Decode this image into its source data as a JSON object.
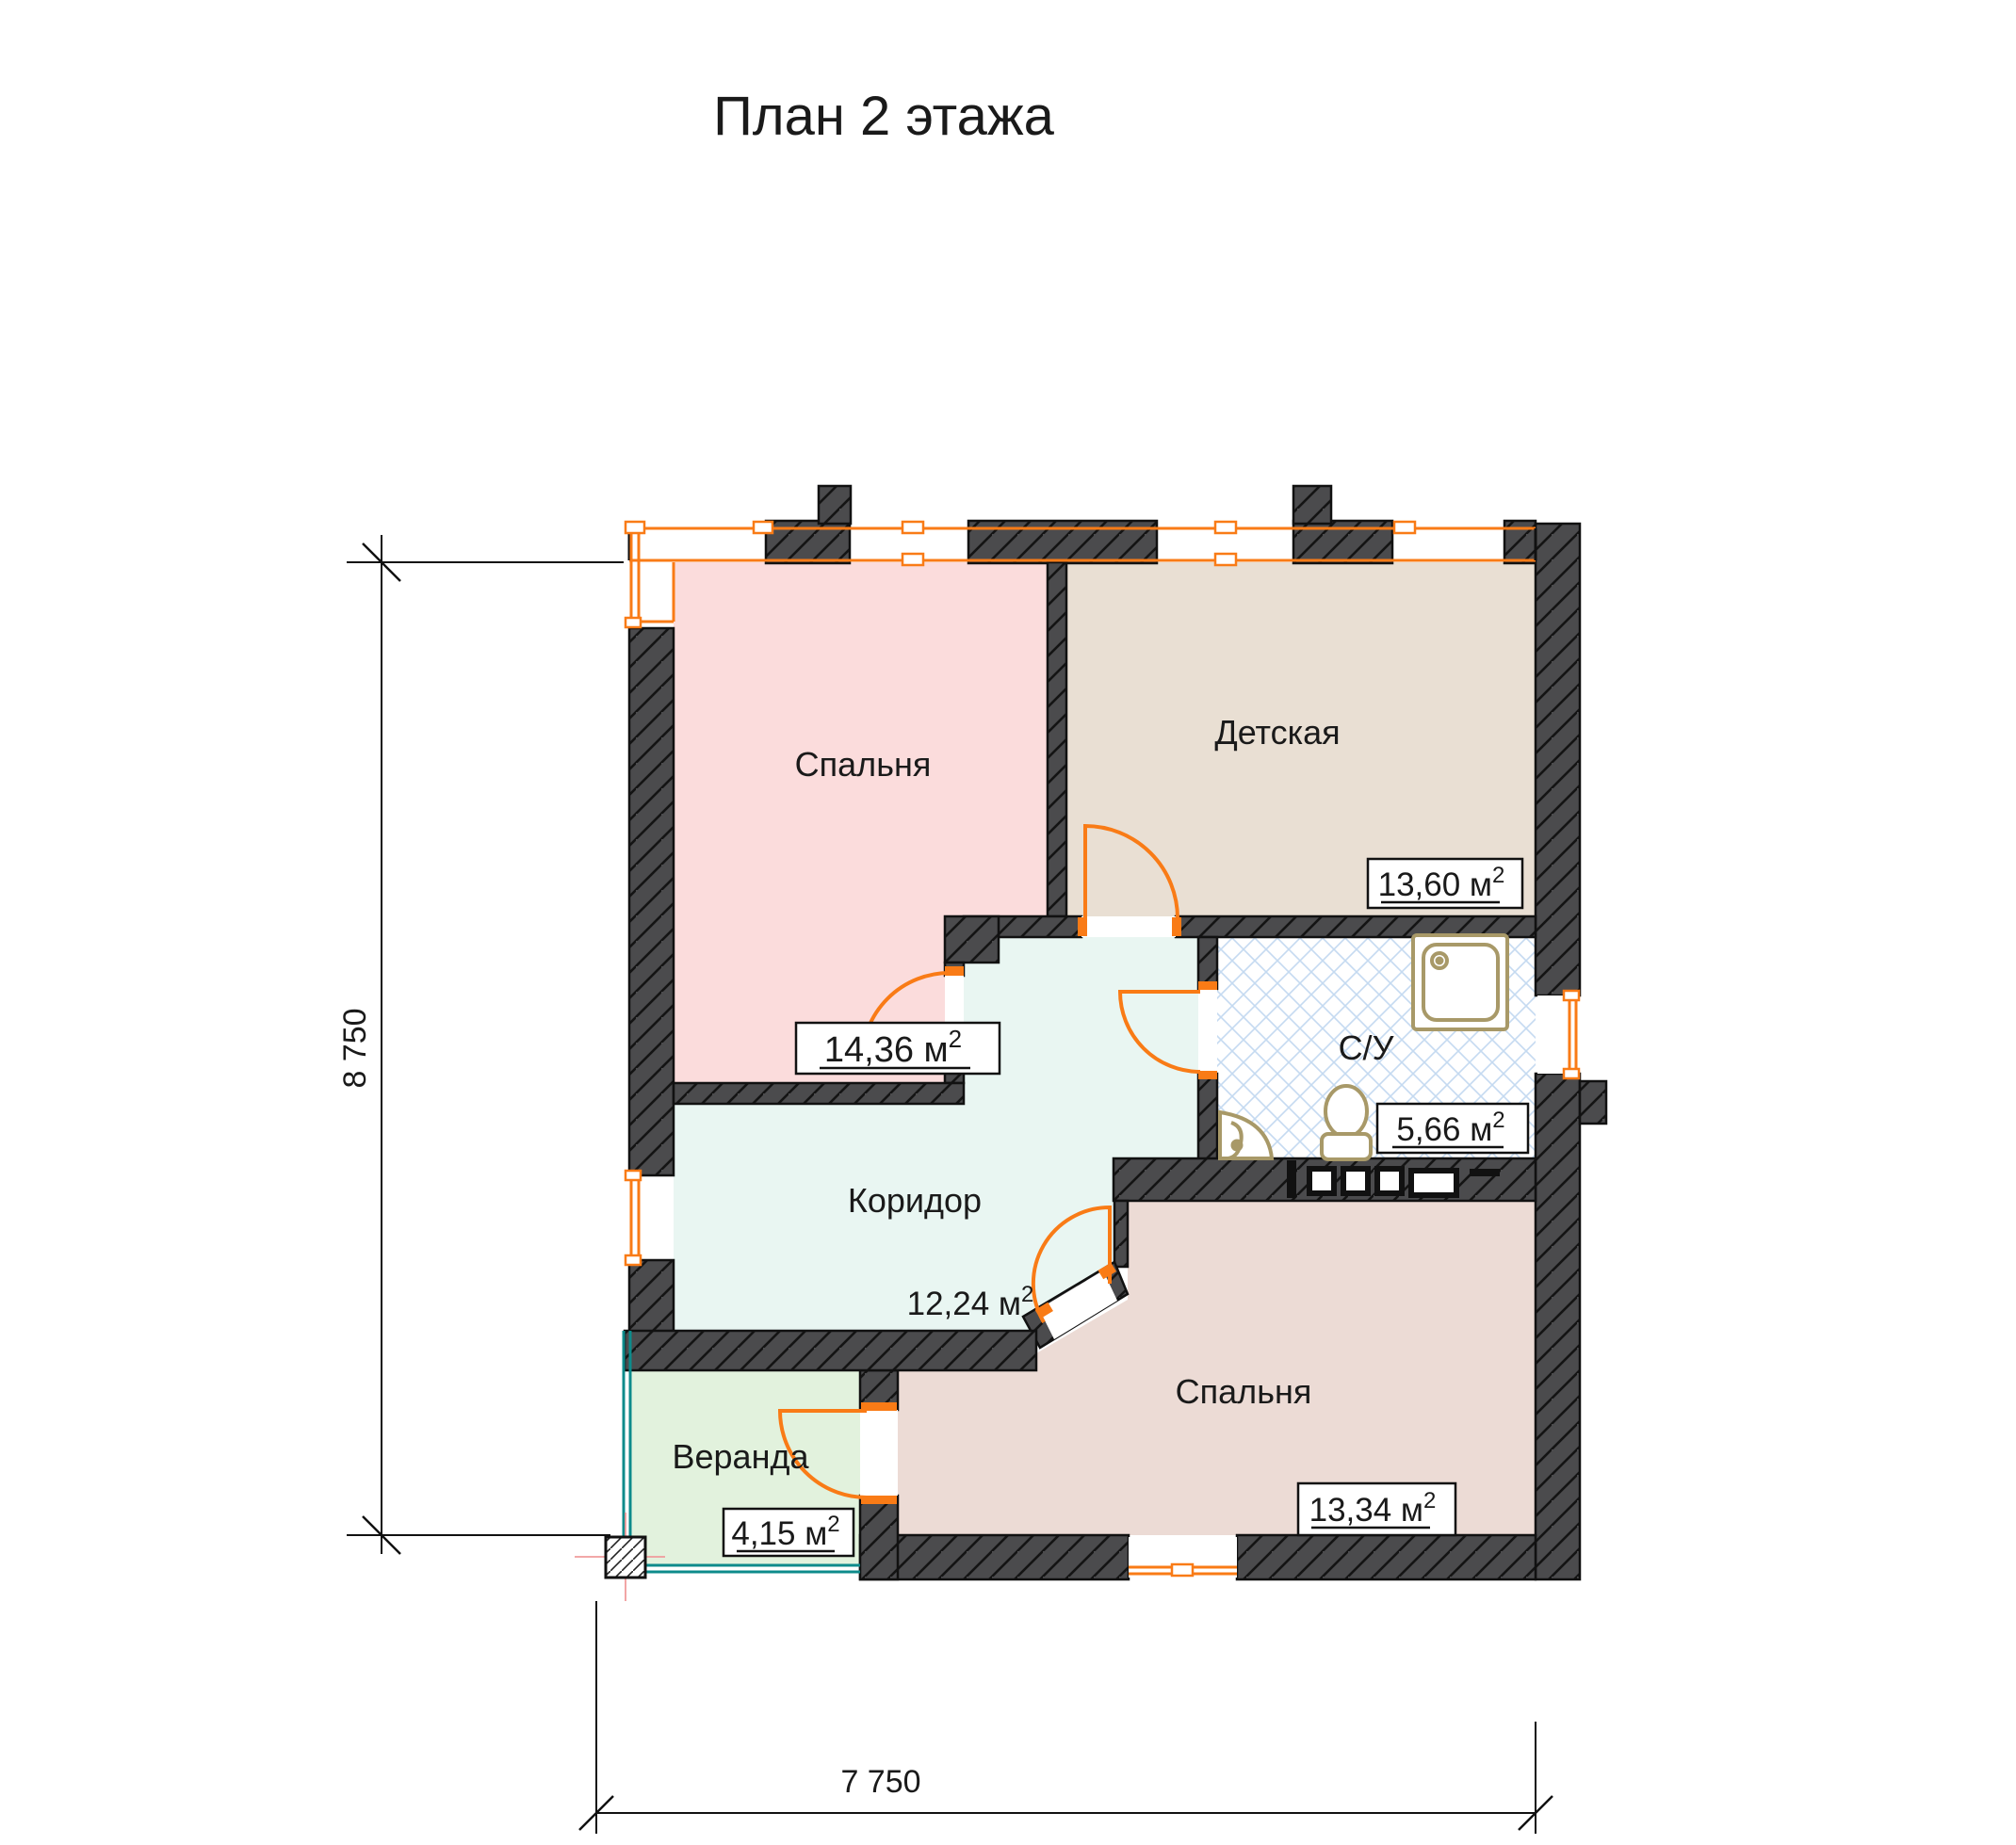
{
  "title": "План 2 этажа",
  "plan": {
    "rooms": [
      {
        "id": "bedroom-top",
        "name": "Спальня",
        "area_value": "14,36 м",
        "area_sup": "2"
      },
      {
        "id": "nursery",
        "name": "Детская",
        "area_value": "13,60 м",
        "area_sup": "2"
      },
      {
        "id": "bathroom",
        "name": "С/У",
        "area_value": "5,66 м",
        "area_sup": "2"
      },
      {
        "id": "corridor",
        "name": "Коридор",
        "area_value": "12,24 м",
        "area_sup": "2"
      },
      {
        "id": "bedroom-bottom",
        "name": "Спальня",
        "area_value": "13,34 м",
        "area_sup": "2"
      },
      {
        "id": "veranda",
        "name": "Веранда",
        "area_value": "4,15 м",
        "area_sup": "2"
      }
    ],
    "dimensions": {
      "height": "8 750",
      "width": "7 750"
    },
    "colors": {
      "accent_orange": "#f97b16",
      "wall_dark": "#4b4b4d",
      "bedroom_top_fill": "#fbdcdc",
      "nursery_fill": "#e9dfd3",
      "corridor_fill": "#e9f6f2",
      "bedroom_bottom_fill": "#ecdbd5",
      "veranda_fill": "#e2f2dd",
      "bathroom_hatch": "#c5daf1",
      "glazing_teal": "#0d8b8b",
      "fixture_tan": "#a89968"
    }
  }
}
